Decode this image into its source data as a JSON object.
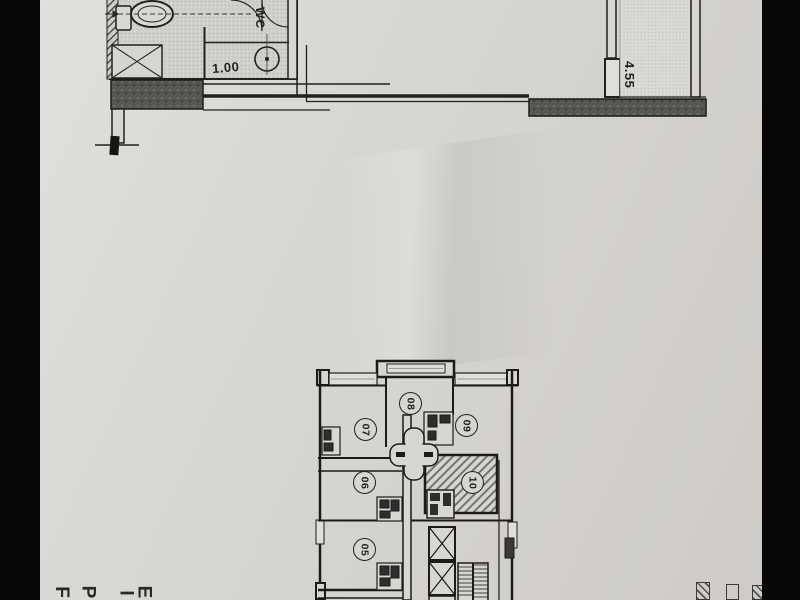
{
  "upper_plan": {
    "wc_label": "WC",
    "dim_horizontal": "1.00",
    "dim_vertical": "4.55"
  },
  "lower_plan": {
    "rooms": [
      {
        "number": "05"
      },
      {
        "number": "06"
      },
      {
        "number": "07"
      },
      {
        "number": "08"
      },
      {
        "number": "09"
      },
      {
        "number": "10"
      }
    ]
  },
  "margin_text_fragments": [
    {
      "char": "F"
    },
    {
      "char": "P"
    },
    {
      "char": "I"
    },
    {
      "char": "E"
    }
  ],
  "colors": {
    "paper": "#d8d6d2",
    "ink": "#22211f",
    "wall_fill": "#55534f",
    "letterbox": "#070707"
  }
}
